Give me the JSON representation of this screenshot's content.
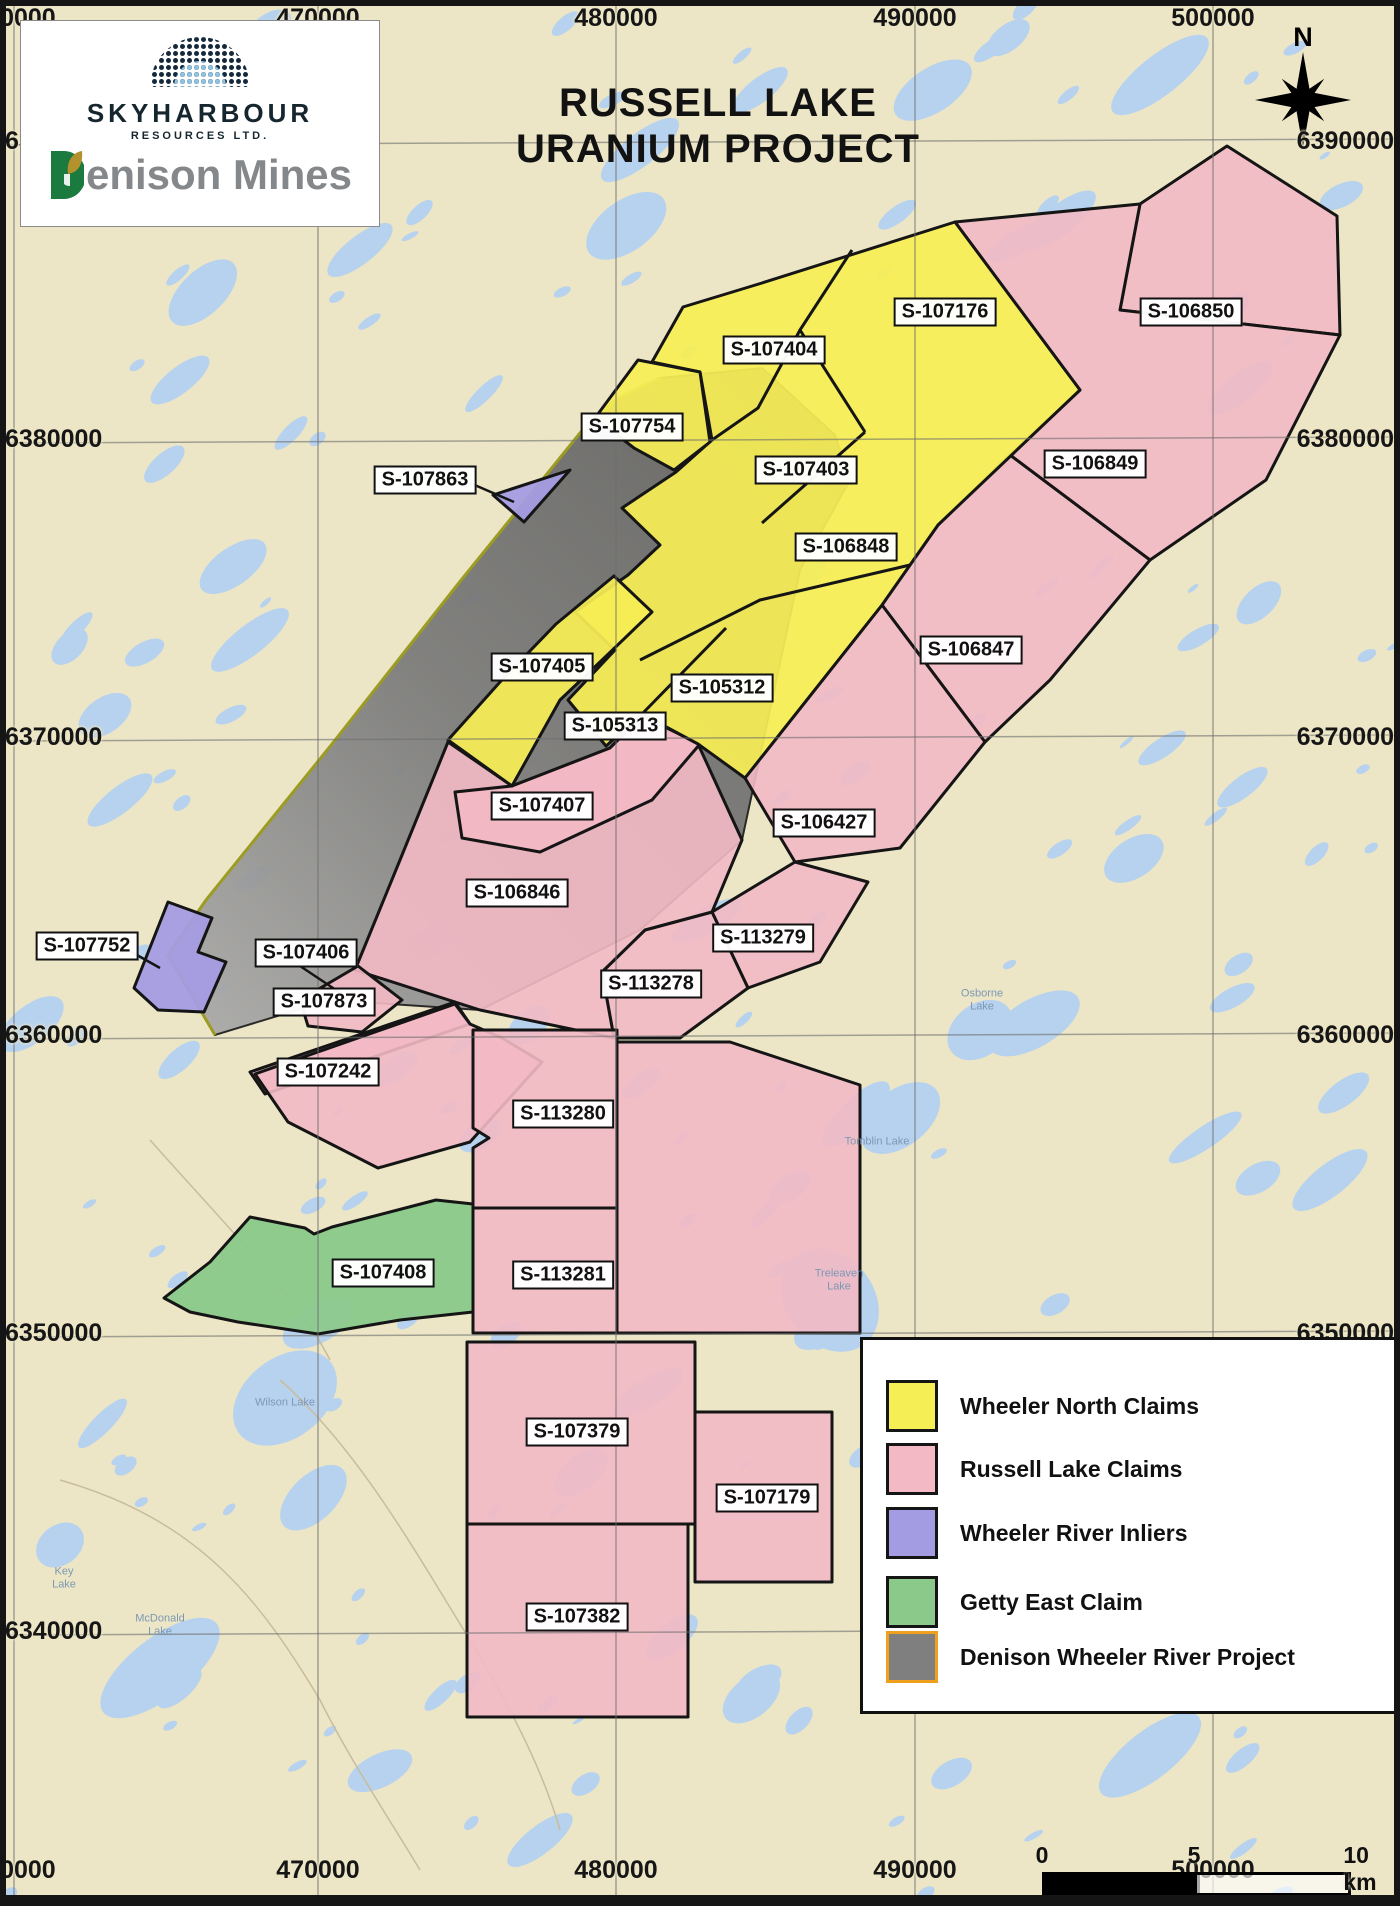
{
  "header": {
    "title_line1": "RUSSELL LAKE",
    "title_line2": "URANIUM PROJECT",
    "north_label": "N"
  },
  "logo": {
    "skyharbour_name": "SKYHARBOUR",
    "skyharbour_sub": "RESOURCES LTD.",
    "denison_text": "enison Mines",
    "dome_icon": "dotted-dome-logo",
    "denison_d_icon": "green-d-leaf-logo"
  },
  "axes": {
    "x_ticks": [
      {
        "label": "460000",
        "x": 14
      },
      {
        "label": "470000",
        "x": 318
      },
      {
        "label": "480000",
        "x": 616
      },
      {
        "label": "490000",
        "x": 915
      },
      {
        "label": "500000",
        "x": 1213
      }
    ],
    "y_ticks": [
      {
        "label": "6390000",
        "y": 142
      },
      {
        "label": "6380000",
        "y": 440
      },
      {
        "label": "6370000",
        "y": 738
      },
      {
        "label": "6360000",
        "y": 1036
      },
      {
        "label": "6350000",
        "y": 1334
      },
      {
        "label": "6340000",
        "y": 1632
      }
    ]
  },
  "claims": [
    {
      "id": "S-107176",
      "x": 945,
      "y": 312,
      "group": "wheeler-north"
    },
    {
      "id": "S-106850",
      "x": 1191,
      "y": 312,
      "group": "russell-lake"
    },
    {
      "id": "S-107404",
      "x": 774,
      "y": 350,
      "group": "wheeler-north"
    },
    {
      "id": "S-107754",
      "x": 632,
      "y": 427,
      "group": "wheeler-north"
    },
    {
      "id": "S-107863",
      "x": 425,
      "y": 480,
      "group": "wheeler-river-inlier",
      "leader": [
        470,
        483,
        514,
        502
      ]
    },
    {
      "id": "S-107403",
      "x": 806,
      "y": 470,
      "group": "wheeler-north"
    },
    {
      "id": "S-106849",
      "x": 1095,
      "y": 464,
      "group": "russell-lake"
    },
    {
      "id": "S-106848",
      "x": 846,
      "y": 547,
      "group": "wheeler-north"
    },
    {
      "id": "S-106847",
      "x": 971,
      "y": 650,
      "group": "russell-lake"
    },
    {
      "id": "S-107405",
      "x": 542,
      "y": 667,
      "group": "wheeler-north"
    },
    {
      "id": "S-105312",
      "x": 722,
      "y": 688,
      "group": "wheeler-north"
    },
    {
      "id": "S-105313",
      "x": 615,
      "y": 726,
      "group": "wheeler-north"
    },
    {
      "id": "S-107407",
      "x": 542,
      "y": 806,
      "group": "russell-lake"
    },
    {
      "id": "S-106427",
      "x": 824,
      "y": 823,
      "group": "russell-lake"
    },
    {
      "id": "S-106846",
      "x": 517,
      "y": 893,
      "group": "russell-lake"
    },
    {
      "id": "S-113279",
      "x": 763,
      "y": 938,
      "group": "russell-lake"
    },
    {
      "id": "S-113278",
      "x": 651,
      "y": 984,
      "group": "russell-lake"
    },
    {
      "id": "S-107752",
      "x": 87,
      "y": 946,
      "group": "wheeler-river-inlier",
      "leader": [
        128,
        950,
        160,
        968
      ]
    },
    {
      "id": "S-107406",
      "x": 306,
      "y": 953,
      "group": "russell-lake",
      "leader": [
        300,
        966,
        342,
        994
      ]
    },
    {
      "id": "S-107873",
      "x": 324,
      "y": 1002,
      "group": "russell-lake"
    },
    {
      "id": "S-107242",
      "x": 328,
      "y": 1072,
      "group": "russell-lake"
    },
    {
      "id": "S-113280",
      "x": 563,
      "y": 1114,
      "group": "russell-lake"
    },
    {
      "id": "S-107408",
      "x": 383,
      "y": 1273,
      "group": "getty-east"
    },
    {
      "id": "S-113281",
      "x": 563,
      "y": 1275,
      "group": "russell-lake"
    },
    {
      "id": "S-107379",
      "x": 577,
      "y": 1432,
      "group": "russell-lake"
    },
    {
      "id": "S-107179",
      "x": 767,
      "y": 1498,
      "group": "russell-lake"
    },
    {
      "id": "S-107382",
      "x": 577,
      "y": 1617,
      "group": "russell-lake"
    }
  ],
  "lake_labels": [
    {
      "text": "Osborne\nLake",
      "x": 982,
      "y": 1000
    },
    {
      "text": "Tomblin Lake",
      "x": 877,
      "y": 1142
    },
    {
      "text": "Treleaven\nLake",
      "x": 839,
      "y": 1280
    },
    {
      "text": "Wilson Lake",
      "x": 285,
      "y": 1403
    },
    {
      "text": "Key\nLake",
      "x": 64,
      "y": 1578
    },
    {
      "text": "McDonald\nLake",
      "x": 160,
      "y": 1625
    }
  ],
  "legend": {
    "items": [
      {
        "label": "Wheeler North Claims",
        "color": "#f6ee55",
        "border": "#151515"
      },
      {
        "label": "Russell Lake Claims",
        "color": "#f3b9c4",
        "border": "#151515"
      },
      {
        "label": "Wheeler River Inliers",
        "color": "#a49ce2",
        "border": "#151515"
      },
      {
        "label": "Getty East Claim",
        "color": "#8bc98b",
        "border": "#151515"
      },
      {
        "label": "Denison Wheeler River Project",
        "color": "#7f7f7f",
        "border": "#f0a01c"
      }
    ]
  },
  "scalebar": {
    "ticks": [
      "0",
      "5",
      "10 km"
    ]
  },
  "colors": {
    "land": "#ece6c6",
    "lake": "#b7d2ee",
    "wheeler_north": "#f6ee55",
    "russell_lake": "#f3b9c4",
    "wheeler_river_inlier": "#a49ce2",
    "getty_east": "#8bc98b",
    "denison_gray_dark": "#5e5e5e",
    "denison_gray_light": "#a5a5a5",
    "denison_edge_olive": "#9c9b22",
    "grid": "#6e6e6e",
    "claim_outline": "#151515"
  }
}
